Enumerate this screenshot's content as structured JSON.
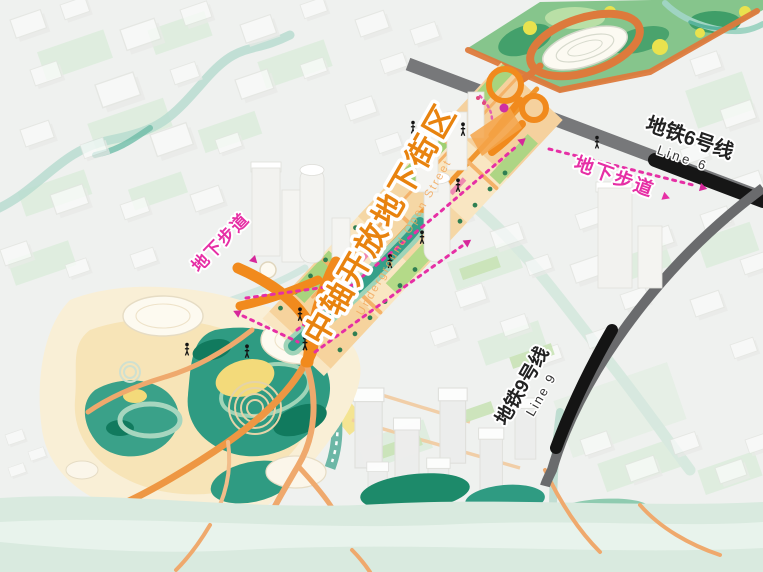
{
  "map": {
    "axis_label": {
      "zh": "中轴开放地下街区",
      "en": "Underground Open Street"
    },
    "metro6": {
      "zh": "地铁6号线",
      "en": "Line 6"
    },
    "metro9": {
      "zh": "地铁9号线",
      "en": "Line 9"
    },
    "walkway_right": {
      "label": "地下步道"
    },
    "walkway_left": {
      "label": "地下步道"
    },
    "colors": {
      "axis_label_orange": "#E8830F",
      "walkway_magenta": "#E62FA5",
      "elevated_path_orange": "#F18A1D",
      "trail_orange": "#EFA96D",
      "park_teal": "#2F9B82",
      "park_dark_teal": "#117A5E",
      "park_band_green": "#86C58C",
      "canal_mint": "#9FD4B8",
      "road_gray": "#696A6C",
      "metro_black": "#141414",
      "river_pale": "#D9EADF",
      "ground_cream": "#F9EFD6"
    },
    "icons": {
      "pedestrian": "pedestrian-icon",
      "direction_arrow": "direction-arrow-icon",
      "metro_station": "metro-station-dot-icon"
    }
  }
}
